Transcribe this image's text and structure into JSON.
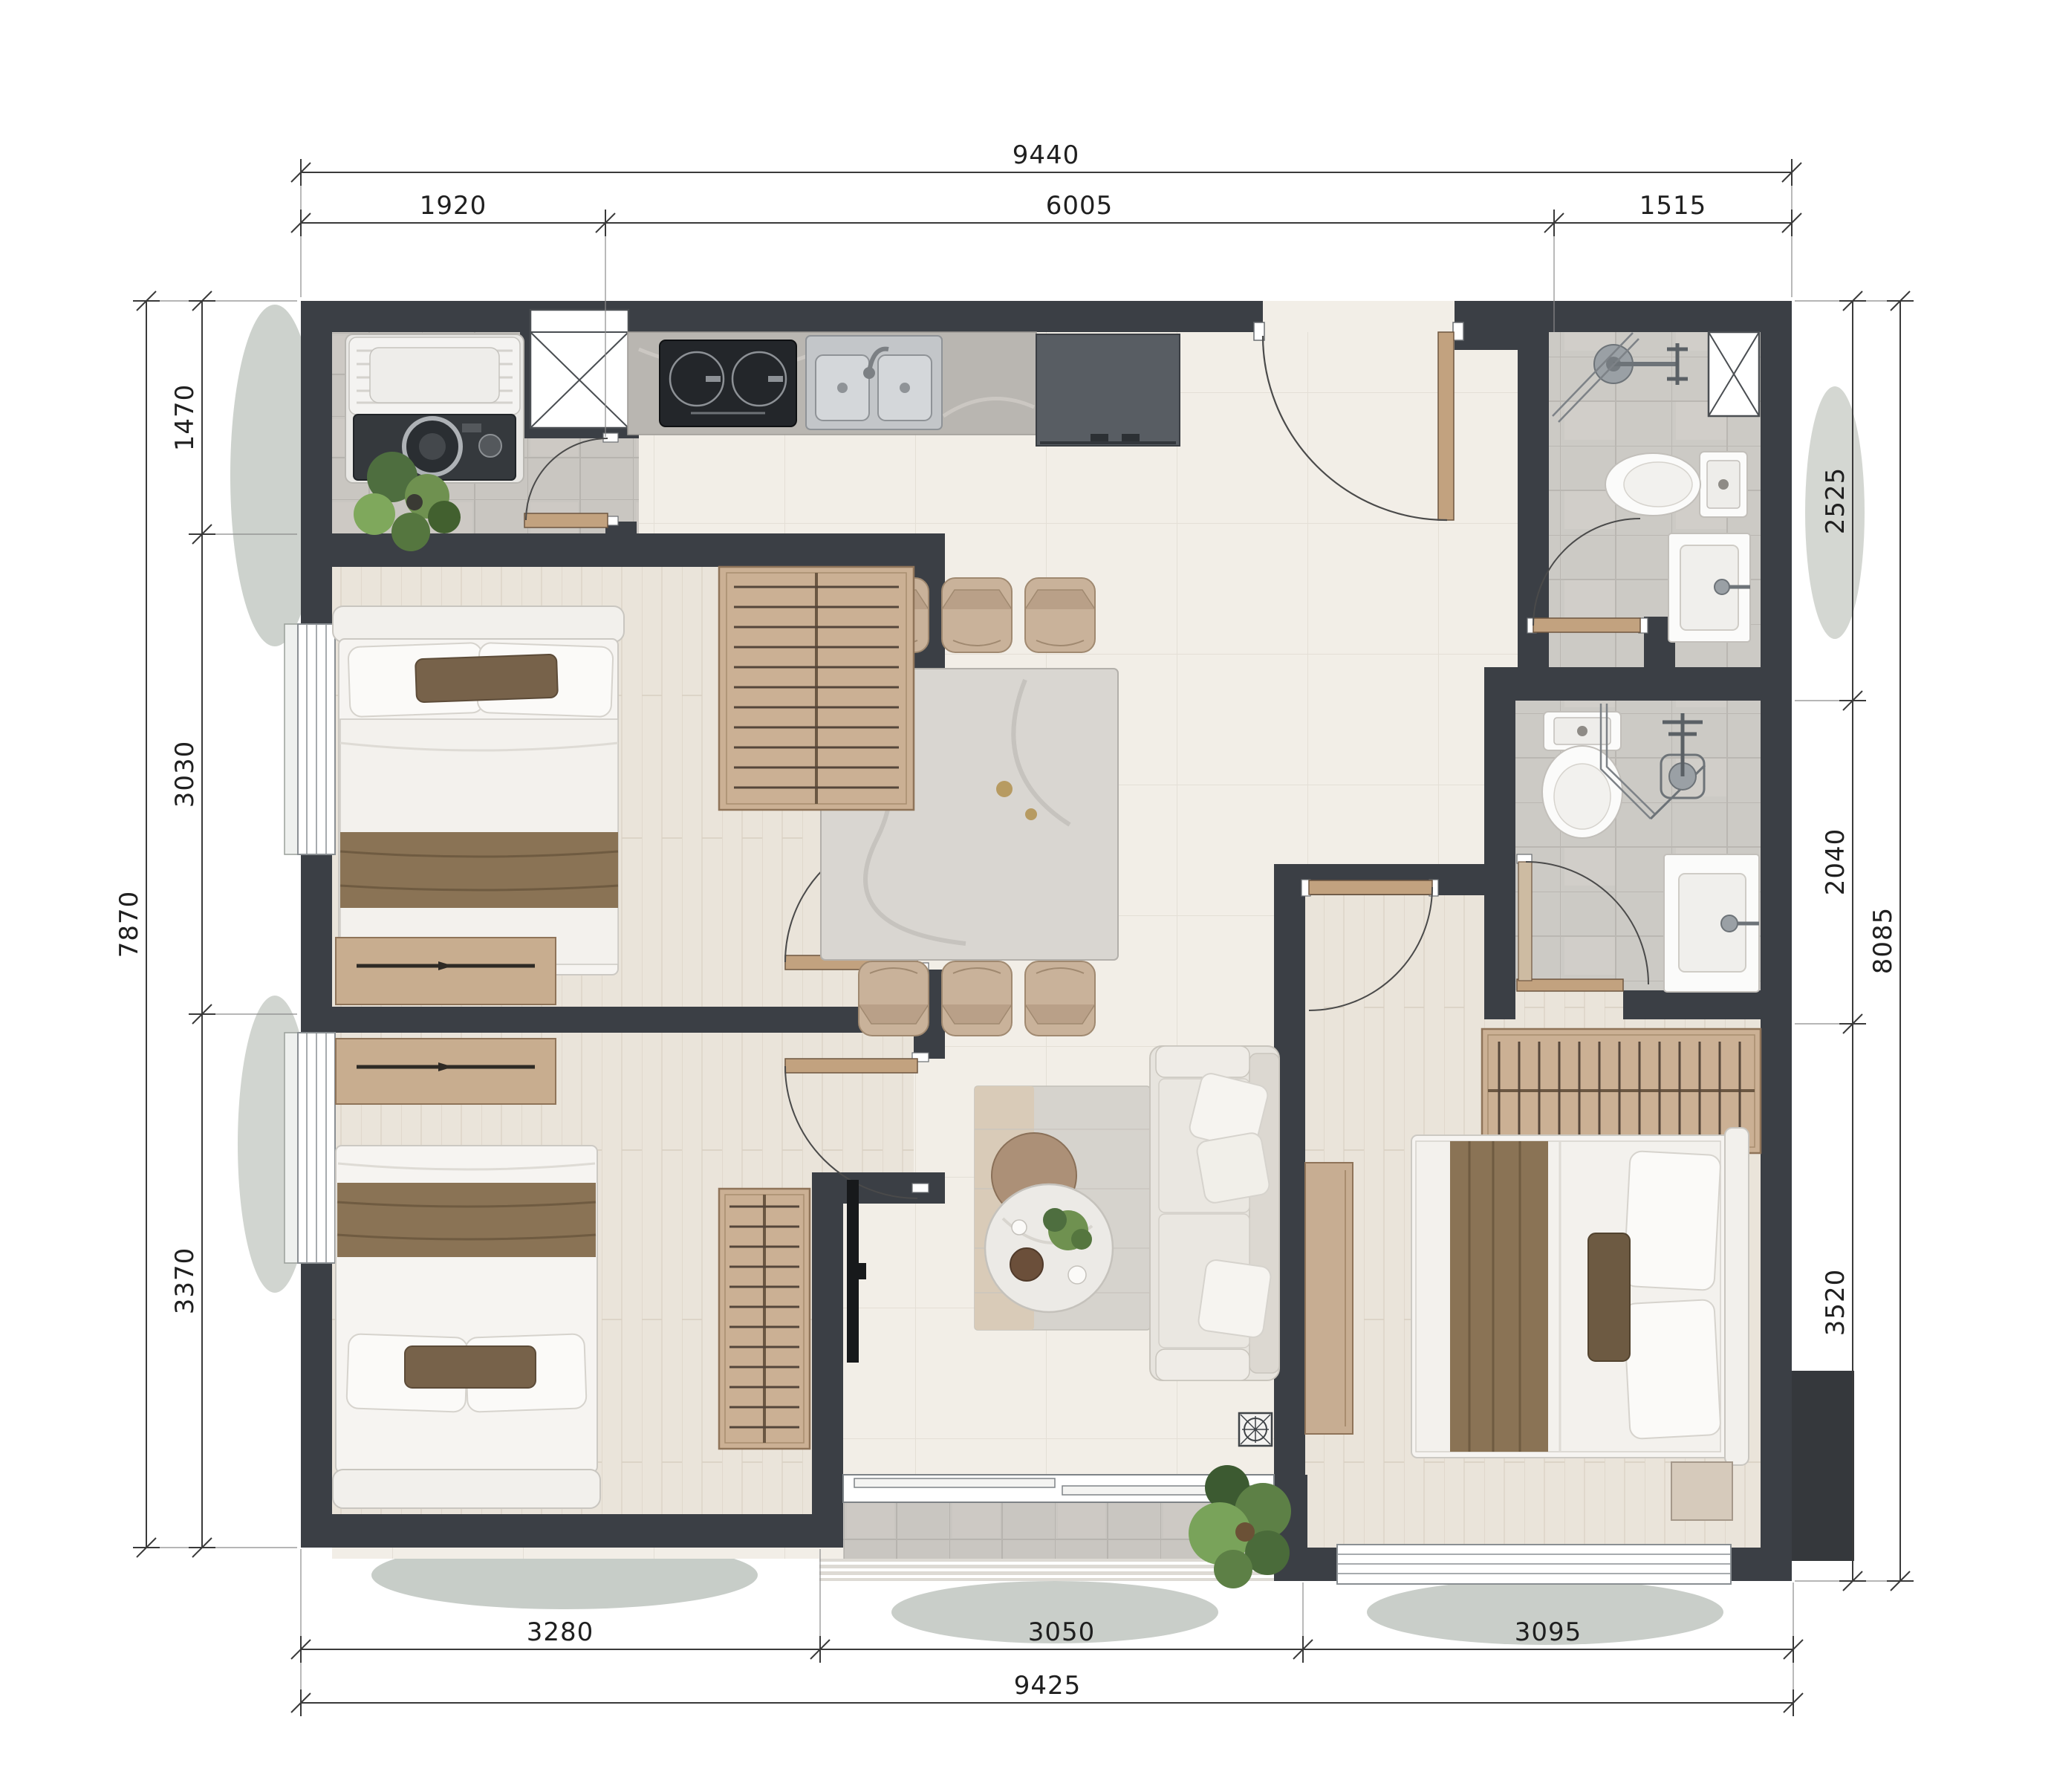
{
  "page": {
    "type": "apartment-floor-plan",
    "background": "#ffffff"
  },
  "dimensions": {
    "top": {
      "total": "9440",
      "segments": [
        "1920",
        "6005",
        "1515"
      ]
    },
    "bottom": {
      "total": "9425",
      "segments": [
        "3280",
        "3050",
        "3095"
      ]
    },
    "left": {
      "total": "7870",
      "segments": [
        "1470",
        "3030",
        "3370"
      ]
    },
    "right": {
      "total": "8085",
      "segments": [
        "2525",
        "2040",
        "3520"
      ]
    }
  },
  "colors": {
    "wall": "#3b3f45",
    "floor_cream": "#f2eee7",
    "floor_gray": "#c9c6c1",
    "floor_wood": "#eae4da",
    "wood_furniture": "#c8ad8f",
    "door_wood": "#c2a27f",
    "appliance_dark": "#2e3237",
    "steel": "#b9bdc1",
    "fixture_white": "#fbfbfa",
    "plant_green": "#679454",
    "dimension_line": "#3a3a3a"
  }
}
